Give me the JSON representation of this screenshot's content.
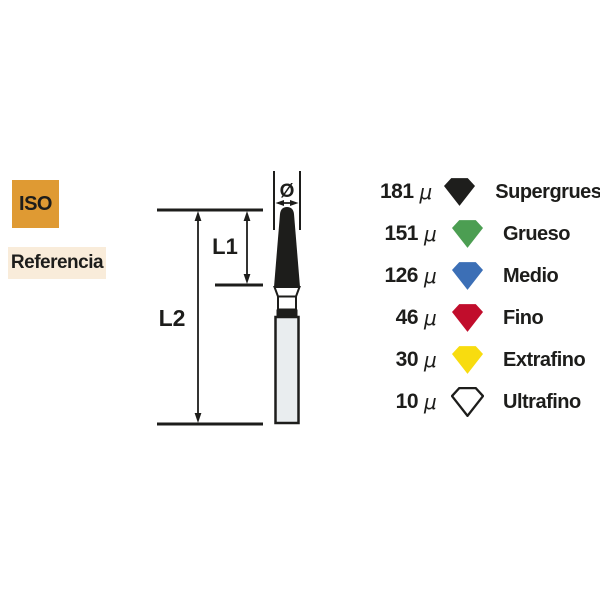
{
  "labels": {
    "iso": "ISO",
    "referencia": "Referencia"
  },
  "diagram": {
    "diameter_symbol": "Ø",
    "l1": "L1",
    "l2": "L2"
  },
  "legend": {
    "unit": "μ",
    "items": [
      {
        "value": "181",
        "name": "Supergrueso",
        "color": "#1e1e1c"
      },
      {
        "value": "151",
        "name": "Grueso",
        "color": "#4c9e52"
      },
      {
        "value": "126",
        "name": "Medio",
        "color": "#3c6fb6"
      },
      {
        "value": "46",
        "name": "Fino",
        "color": "#c10d2c"
      },
      {
        "value": "30",
        "name": "Extrafino",
        "color": "#f8dc0f"
      },
      {
        "value": "10",
        "name": "Ultrafino",
        "color": "#ffffff",
        "stroke": "#1d1d1b"
      }
    ]
  },
  "colors": {
    "background": "#ffffff",
    "ink": "#1d1d1b",
    "iso_bg": "#df9a33",
    "referencia_bg": "#f9ecda",
    "shank_fill": "#e9edef"
  }
}
